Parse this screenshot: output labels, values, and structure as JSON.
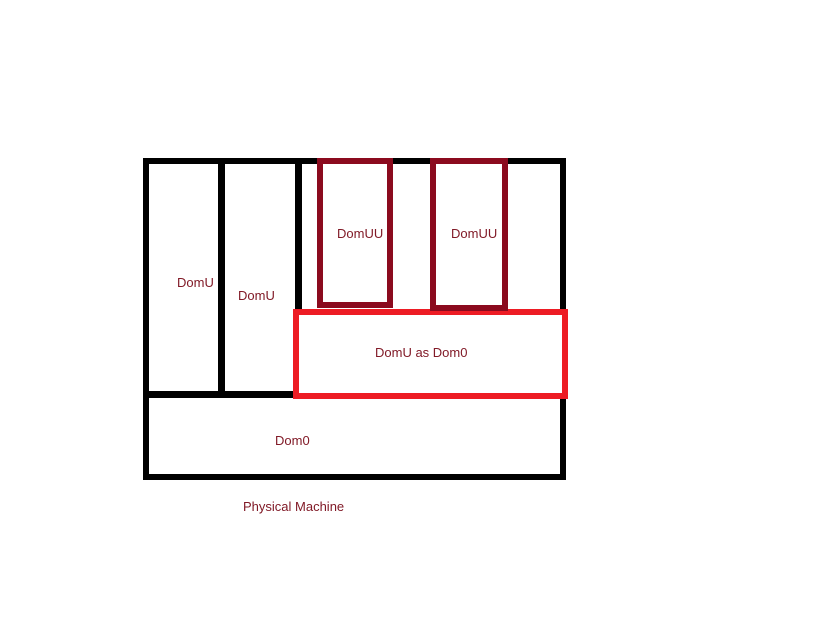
{
  "diagram": {
    "labels": {
      "domu1": "DomU",
      "domu2": "DomU",
      "domuu1": "DomUU",
      "domuu2": "DomUU",
      "domu_as_dom0": "DomU as Dom0",
      "dom0": "Dom0",
      "physical_machine": "Physical Machine"
    },
    "colors": {
      "background": "#ffffff",
      "outline": "#000000",
      "domuu_border": "#8b0a1e",
      "domu_as_dom0_border": "#ed1c24",
      "label_text": "#811a27"
    }
  }
}
